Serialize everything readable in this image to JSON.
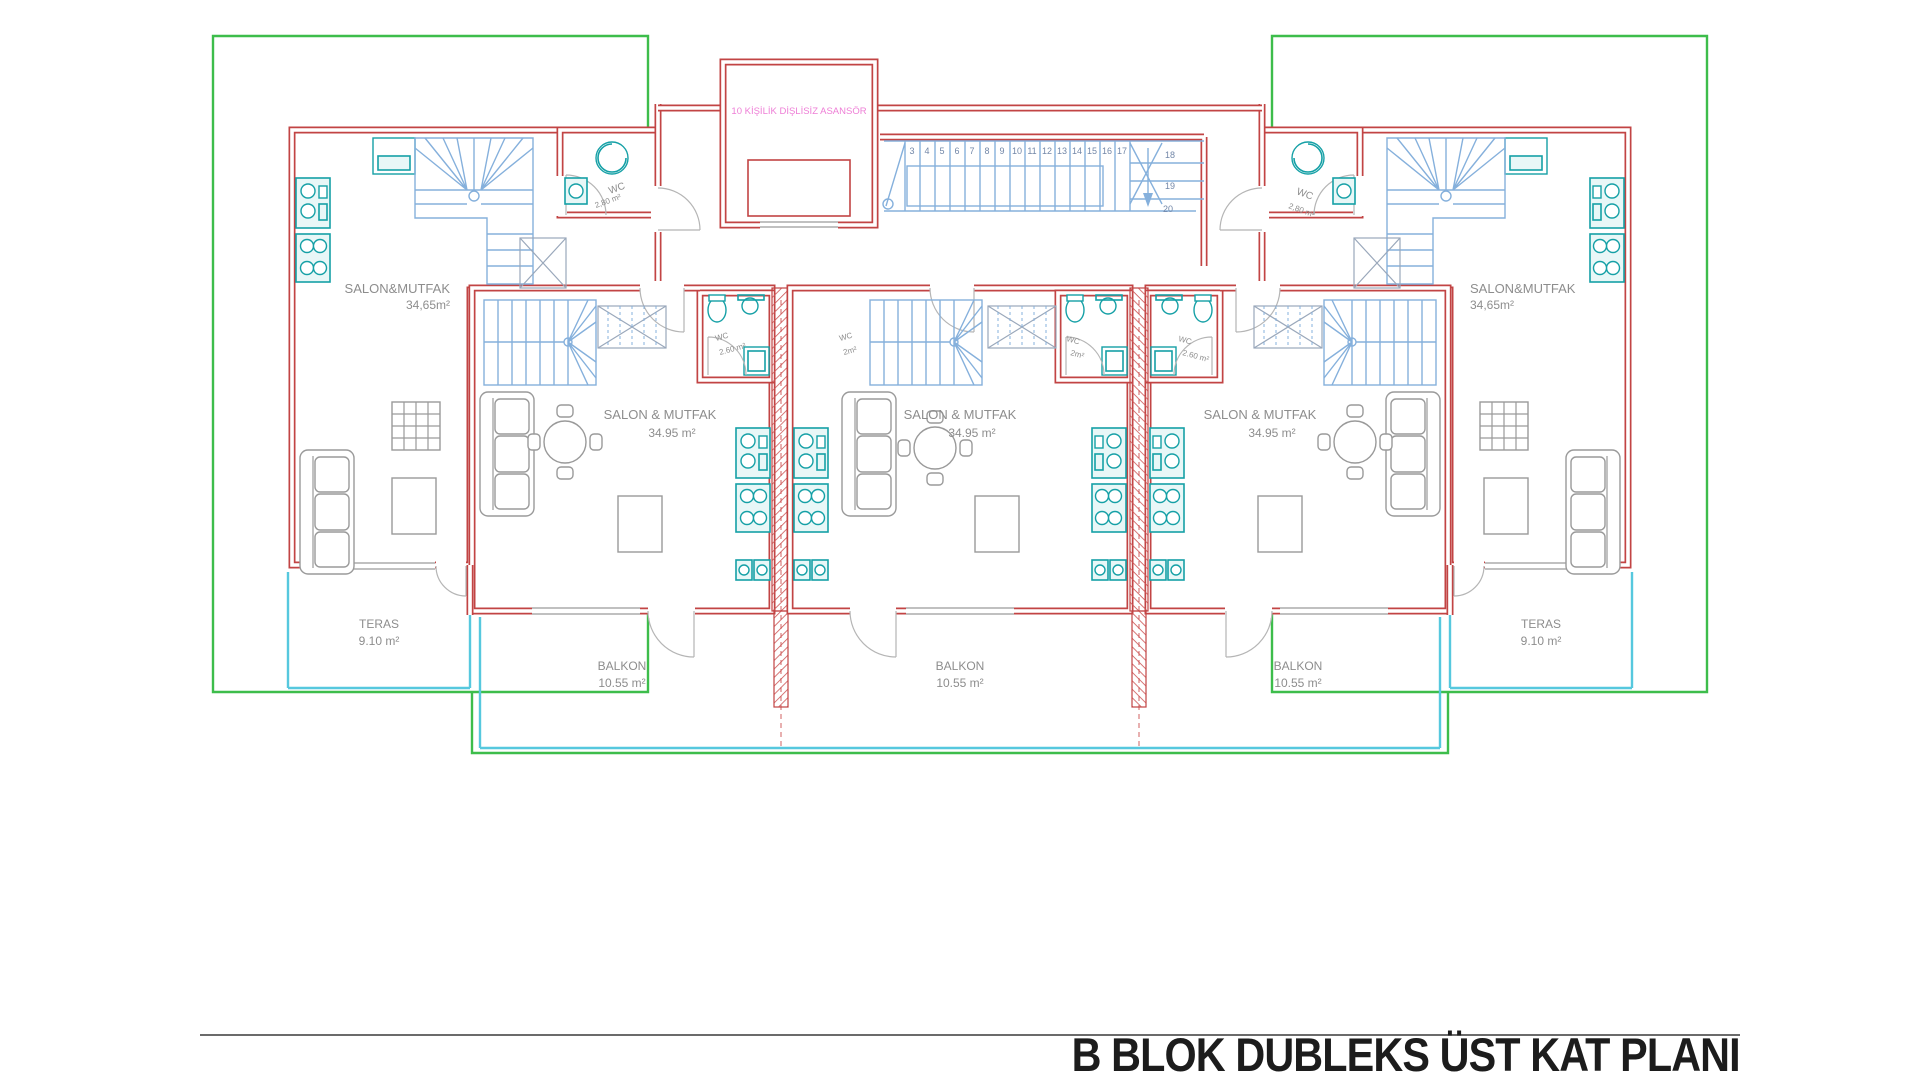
{
  "title_block": {
    "plan_title": "B BLOK DUBLEKS ÜST KAT PLANI"
  },
  "colors": {
    "wall_red": "#c24444",
    "outline_green": "#3dbd4b",
    "stair_blue": "#85b0dc",
    "fixture_teal": "#15a0a6",
    "rail_cyan": "#56c8de",
    "label_gray": "#8d8d8d",
    "elevator_pink": "#ee7ed6",
    "title_black": "#1c1c1c"
  },
  "plan": {
    "elevator": {
      "label": "10 KİŞİLİK DİŞLİSİZ ASANSÖR"
    },
    "units": {
      "outer_left": {
        "name": "SALON&MUTFAK",
        "area": "34,65m²"
      },
      "inner_left": {
        "name": "SALON & MUTFAK",
        "area": "34.95 m²"
      },
      "center": {
        "name": "SALON & MUTFAK",
        "area": "34.95 m²"
      },
      "inner_right": {
        "name": "SALON & MUTFAK",
        "area": "34.95 m²"
      },
      "outer_right": {
        "name": "SALON&MUTFAK",
        "area": "34,65m²"
      }
    },
    "wc_rooms": {
      "left": {
        "name": "WC",
        "area": "2,80 m²"
      },
      "right": {
        "name": "WC",
        "area": "2,80 m²"
      }
    },
    "baths": [
      {
        "name": "WC",
        "area": "2.60 m²"
      },
      {
        "name": "WC",
        "area": "2m²"
      },
      {
        "name": "WC",
        "area": "2m²"
      },
      {
        "name": "WC",
        "area": "2.60 m²"
      }
    ],
    "terraces": {
      "left": {
        "name": "TERAS",
        "area": "9.10 m²"
      },
      "right": {
        "name": "TERAS",
        "area": "9.10 m²"
      }
    },
    "balconies": [
      {
        "name": "BALKON",
        "area": "10.55 m²"
      },
      {
        "name": "BALKON",
        "area": "10.55 m²"
      },
      {
        "name": "BALKON",
        "area": "10.55 m²"
      }
    ],
    "central_stair": {
      "numbers": [
        "3",
        "4",
        "5",
        "6",
        "7",
        "8",
        "9",
        "10",
        "11",
        "12",
        "13",
        "14",
        "15",
        "16",
        "17"
      ],
      "turn_numbers": [
        "18",
        "19",
        "20"
      ]
    }
  }
}
